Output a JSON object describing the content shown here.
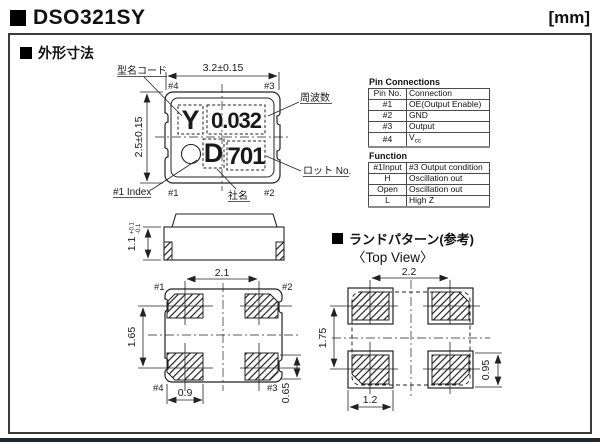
{
  "page": {
    "title": "DSO321SY",
    "unit_label": "[mm]"
  },
  "sections": {
    "outline_title": "外形寸法",
    "land_title": "ランドパターン(参考)",
    "land_subtitle": "〈Top View〉"
  },
  "top_view": {
    "dim_width": "3.2±0.15",
    "dim_height": "2.5±0.15",
    "pad_tl": "#4",
    "pad_tr": "#3",
    "pad_bl": "#1",
    "pad_br": "#2",
    "mark_code": "Y",
    "mark_freq": "0.032",
    "mark_company": "D",
    "mark_lot": "701",
    "label_model_code": "型名コード",
    "label_frequency": "周波数",
    "label_lot": "ロット No.",
    "label_company": "社名",
    "label_index": "#1 Index"
  },
  "side_view": {
    "dim_height": "1.1",
    "tol_plus": "+0.1",
    "tol_minus": "-0.1"
  },
  "bottom_view": {
    "dim_pitch_x": "2.1",
    "dim_pitch_y": "1.65",
    "dim_pad_w": "0.9",
    "dim_pad_h": "0.65",
    "pad_tl": "#1",
    "pad_tr": "#2",
    "pad_bl": "#4",
    "pad_br": "#3"
  },
  "land_pattern": {
    "dim_pitch_x": "2.2",
    "dim_pitch_y": "1.75",
    "dim_pad_w": "1.2",
    "dim_pad_h": "0.95"
  },
  "pin_connections": {
    "title": "Pin Connections",
    "col_pin": "Pin No.",
    "col_conn": "Connection",
    "rows": [
      [
        "#1",
        "OE(Output Enable)"
      ],
      [
        "#2",
        "GND"
      ],
      [
        "#3",
        "Output"
      ],
      [
        "#4",
        "Vcc"
      ]
    ],
    "vcc_base": "V",
    "vcc_sub": "cc"
  },
  "function_table": {
    "title": "Function",
    "col_input": "#1Input",
    "col_condition": "#3 Output condition",
    "rows": [
      [
        "H",
        "Oscillation out"
      ],
      [
        "Open",
        "Oscillation out"
      ],
      [
        "L",
        "High Z"
      ]
    ]
  }
}
